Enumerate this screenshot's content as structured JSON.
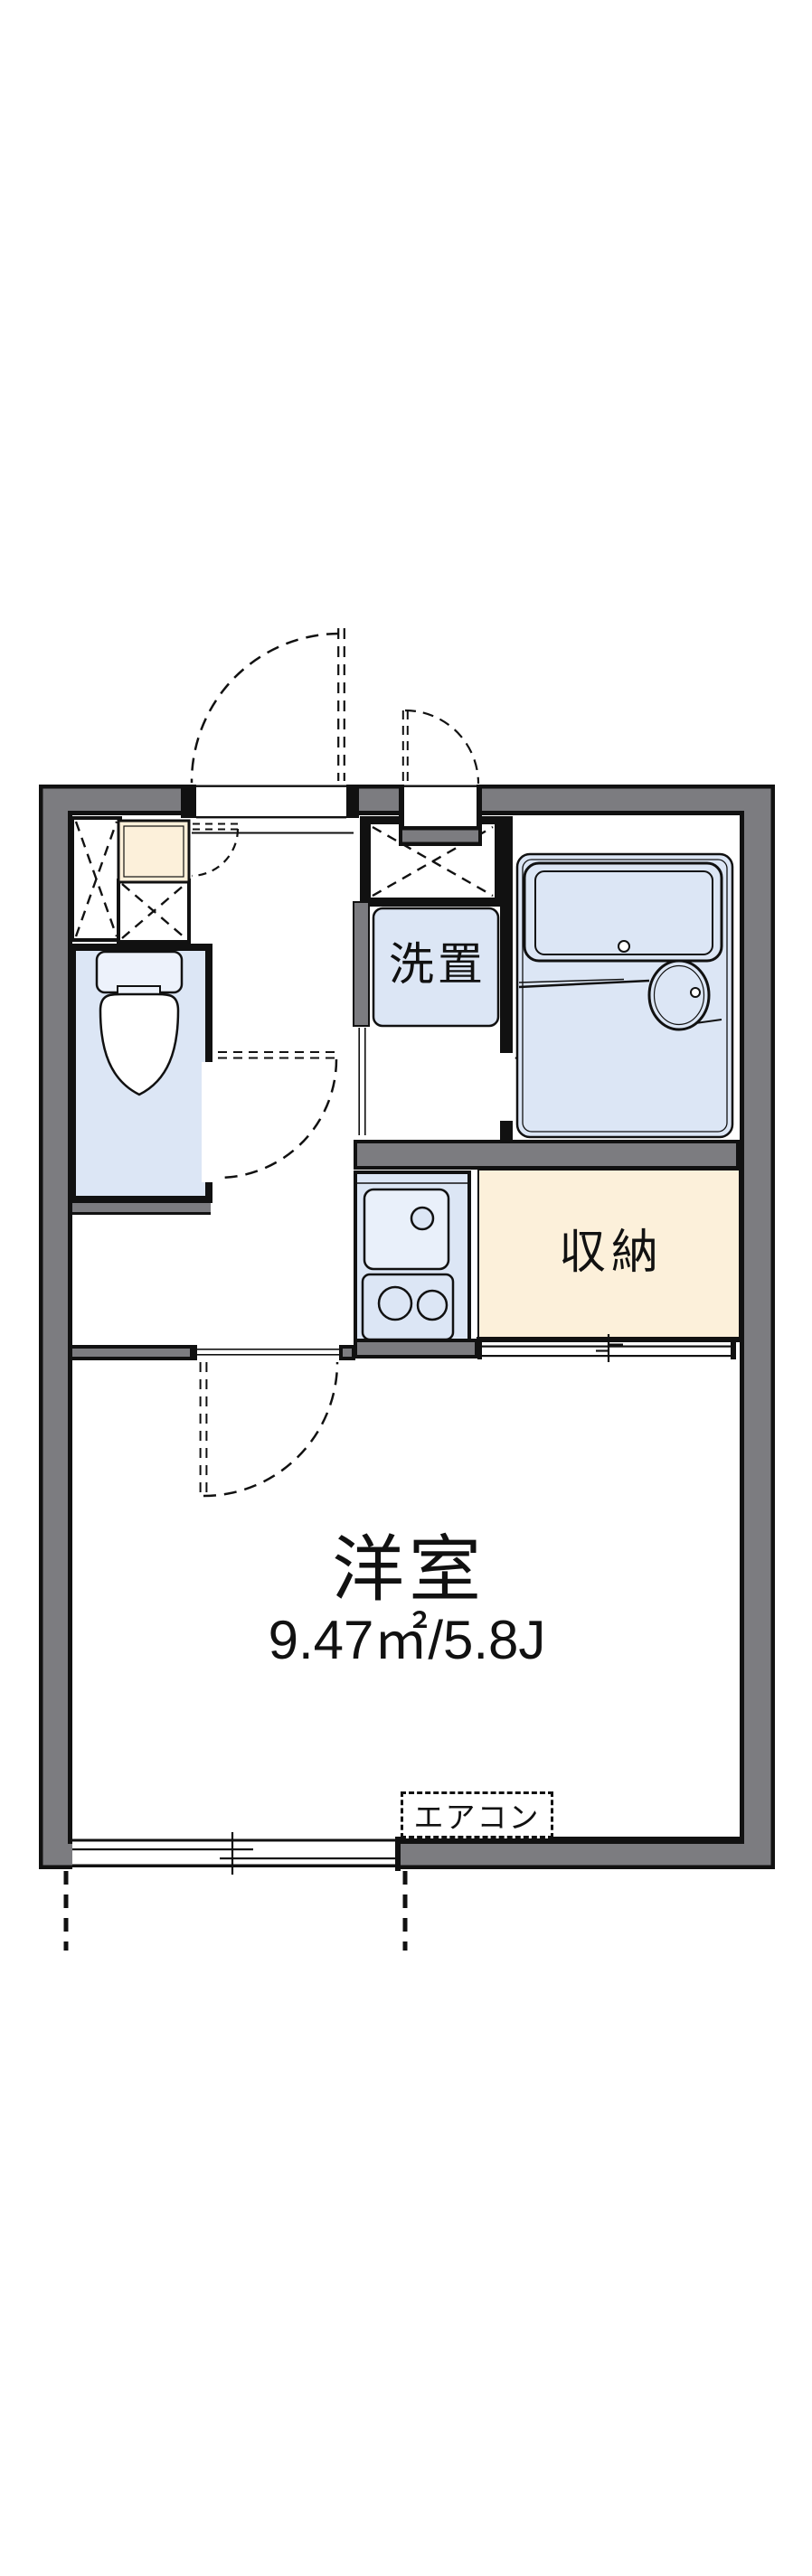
{
  "labels": {
    "room_name": "洋室",
    "room_size": "9.47㎡/5.8J",
    "closet": "収納",
    "washer_space": "洗置",
    "air_conditioner": "エアコン"
  },
  "colors": {
    "background": "#ffffff",
    "line_black": "#111111",
    "wall_gray": "#7c7c80",
    "fixture_blue": "#dce6f5",
    "fixture_blue_light": "#e9f0fa",
    "cabinet_cream": "#fcf0da"
  }
}
